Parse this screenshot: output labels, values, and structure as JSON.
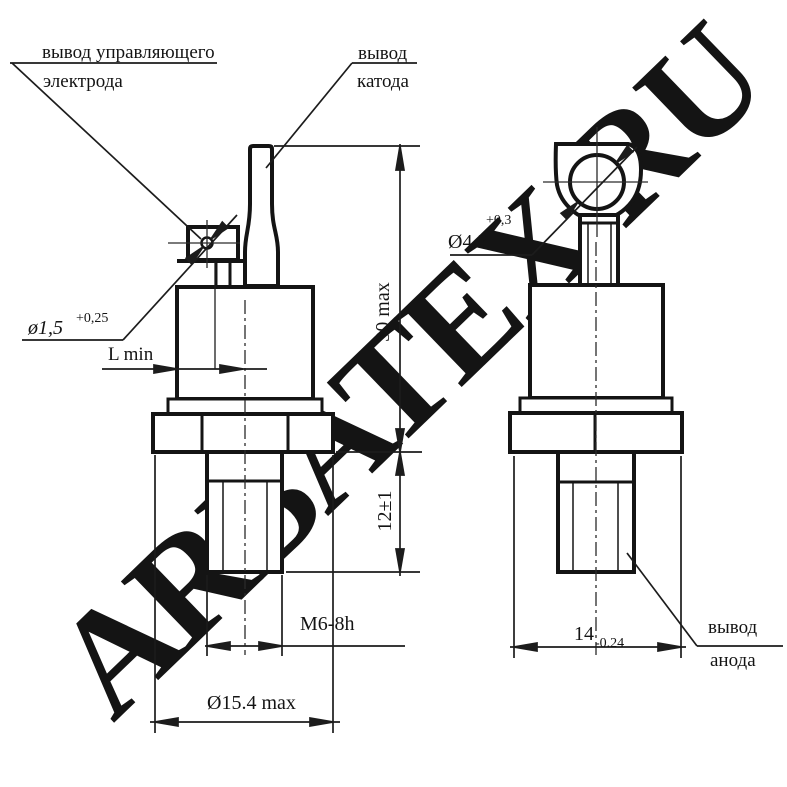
{
  "watermark": {
    "text": "ARBATEX.RU",
    "color": "#f4a0a0"
  },
  "labels": {
    "gate_line1": "вывод управляющего",
    "gate_line2": "электрода",
    "cathode_line1": "вывод",
    "cathode_line2": "катода",
    "anode_line1": "вывод",
    "anode_line2": "анода"
  },
  "dimensions": {
    "gate_hole_diameter": "ø1,5",
    "gate_hole_tolerance": "+0,25",
    "lug_hole_diameter": "Ø4.3",
    "lug_hole_tolerance": "+0,3",
    "overall_height": "30 max",
    "stud_length": "12±1",
    "gate_lead_length": "L min",
    "thread": "M6-8h",
    "body_diameter": "Ø15.4 max",
    "hex_across_flats": "14",
    "hex_tolerance": "-0.24"
  }
}
